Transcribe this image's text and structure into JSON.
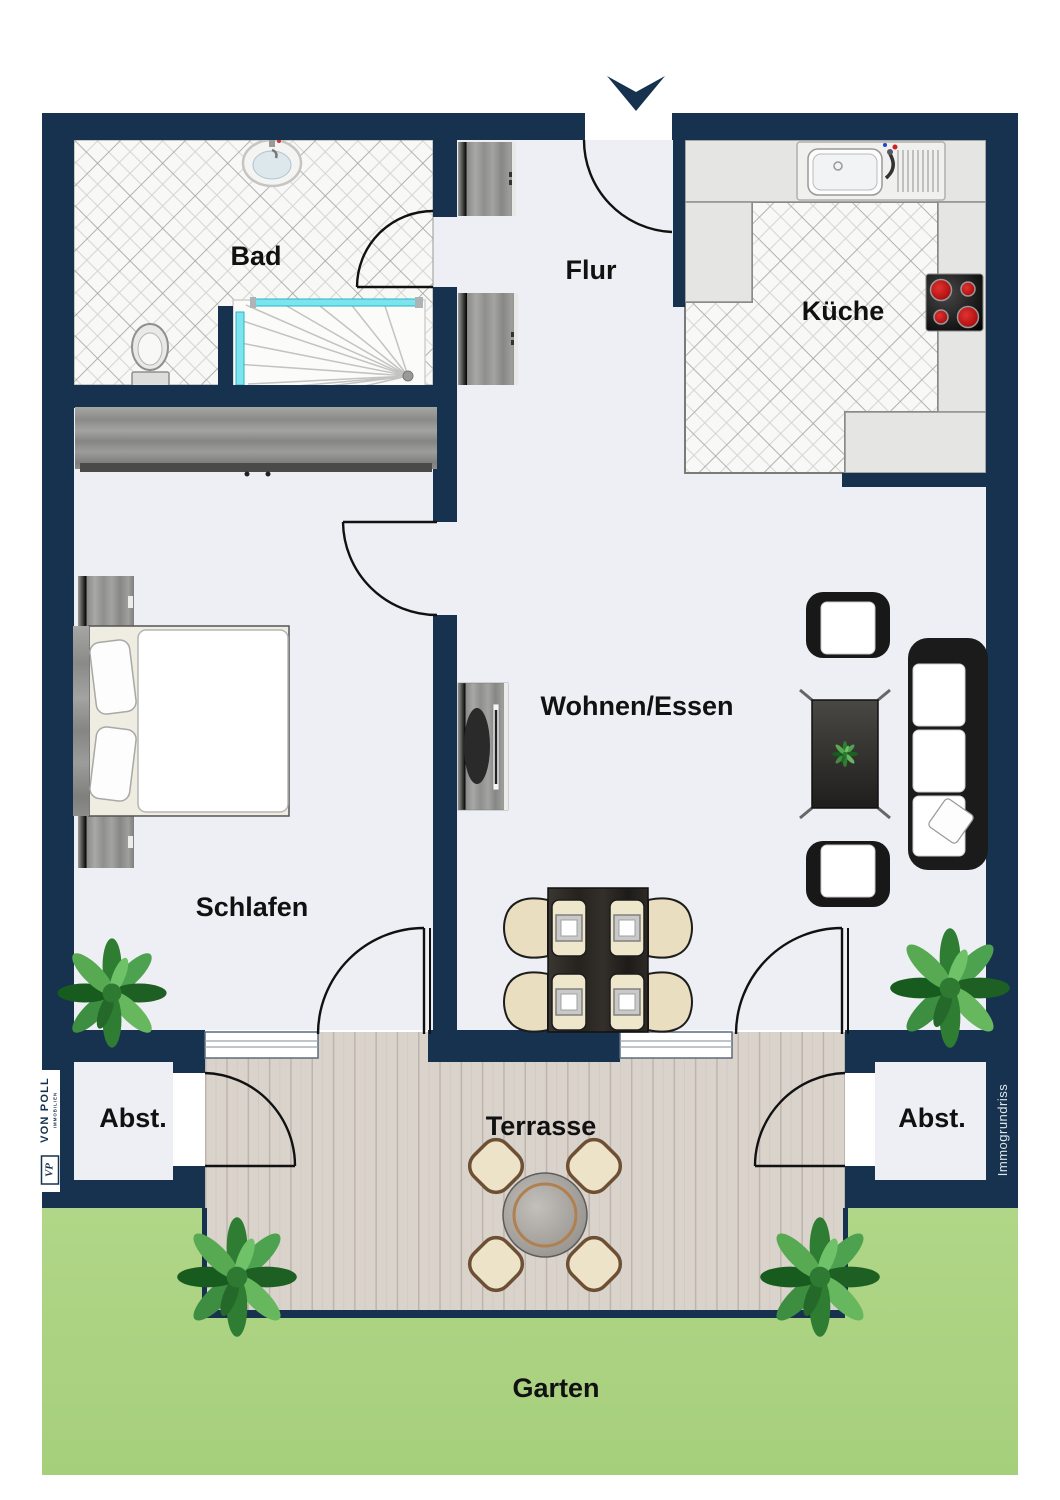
{
  "page": {
    "type": "floor-plan",
    "width_px": 1060,
    "height_px": 1500
  },
  "rooms": {
    "bad": {
      "label": "Bad"
    },
    "flur": {
      "label": "Flur"
    },
    "kueche": {
      "label": "Küche"
    },
    "wohnen_essen": {
      "label": "Wohnen/Essen"
    },
    "schlafen": {
      "label": "Schlafen"
    },
    "abstellraum_links": {
      "label": "Abst."
    },
    "abstellraum_rechts": {
      "label": "Abst."
    },
    "terrasse": {
      "label": "Terrasse"
    },
    "garten": {
      "label": "Garten"
    }
  },
  "branding": {
    "agency_name": "VON POLL",
    "agency_subtitle": "IMMOBILIEN",
    "agency_monogram": "VP",
    "watermark": "Immogrundriss"
  },
  "colors": {
    "wall": "#16324f",
    "floor": "#edeff4",
    "tile_floor": "#f8f8f6",
    "counter": "#e5e5e3",
    "terrace_wood": "#d9d3cc",
    "garden_green": "#acd384",
    "glass_cyan": "#7de4ee",
    "burner_red": "#c41414",
    "gray_wood": "#9a9a98",
    "furniture_black": "#1b1b1b",
    "chair_cream": "#e9dfc0",
    "label_text": "#111111",
    "watermark_text": "#dfe5ec"
  }
}
